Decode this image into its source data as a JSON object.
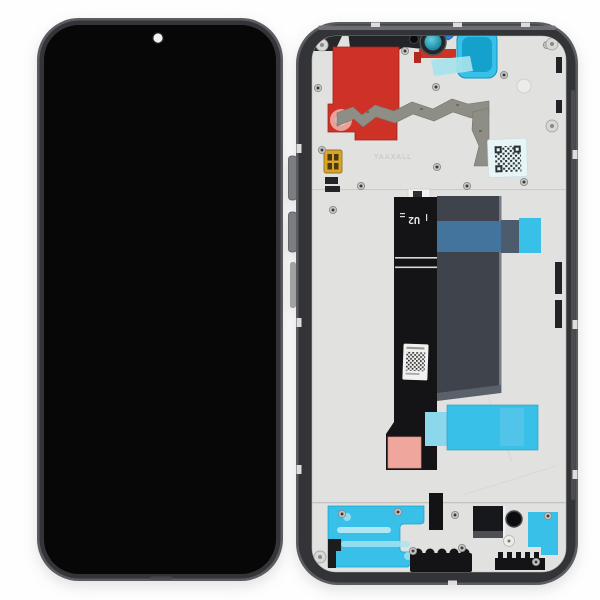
{
  "photo": {
    "description": "Smartphone LCD display and digitizer assembly with middle frame - front (black screen) and back (frame with flex cable and stickers)",
    "flex_cable_label": "U2",
    "watermark_text": "YAAXALL"
  },
  "colors": {
    "bg": "#fefefe",
    "frameEdge": "#5b5c60",
    "frame": "#333437",
    "screen": "#070708",
    "plate": "#e1e1df",
    "red": "#ce3226",
    "redDark": "#b02a1f",
    "pinkDot": "#e8a29a",
    "cyan": "#38c0e8",
    "cyanDeep": "#14a1cb",
    "paleTeal": "#a7e3ea",
    "blueTab": "#2f7ed3",
    "steelBlue": "#42749e",
    "slateSq": "#4d5c6c",
    "shield": "#3f434c",
    "flex": "#141417",
    "graphite": "#8e8e87",
    "gold": "#d8a42c",
    "pinkPad": "#efa79d",
    "label": "#f1f1ef",
    "ink": "#232427",
    "notch": "#dddddb",
    "camDot": "#f2f2f2"
  }
}
